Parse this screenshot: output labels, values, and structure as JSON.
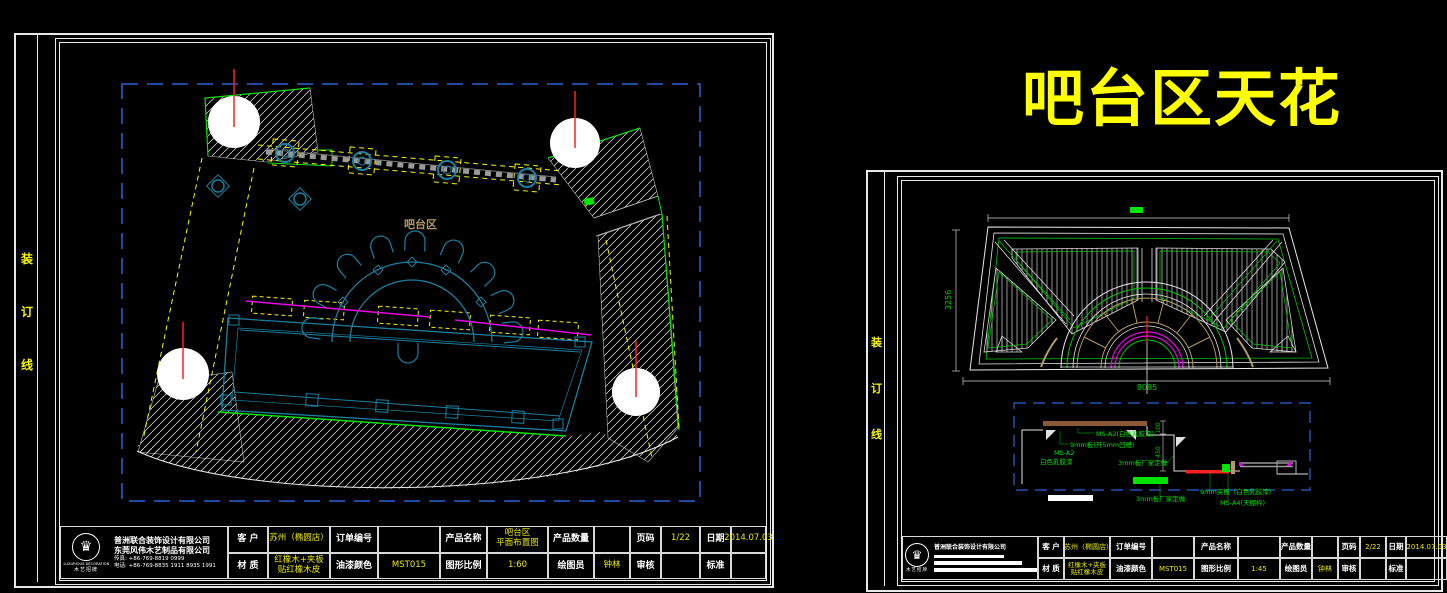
{
  "banner": {
    "title": "吧台区天花"
  },
  "palette": {
    "cad_blue": "#2a62d4",
    "cad_teal": "#1a7f9e",
    "cad_green": "#00e400",
    "cad_yellow": "#f8f800",
    "cad_magenta": "#e800e8",
    "cad_red": "#ff2020",
    "cad_tan": "#b29a62",
    "banner_yellow": "#ffff00"
  },
  "left_sheet": {
    "binding": [
      "装",
      "订",
      "线"
    ],
    "plan_label": "吧台区",
    "company": {
      "name1": "普洲联合装饰设计有限公司",
      "name2": "东莞风伟木艺制品有限公司",
      "tel1": "传真: +86-769-8819 0999",
      "tel2": "电话: +86-769-8835 1911 8935 1991",
      "logo_caption": "LUXURIOUS DECORATION",
      "logo_sub": "木艺招牌"
    },
    "fields": {
      "client_label": "客 户",
      "client": "苏州（椭圆店）",
      "order_label": "订单编号",
      "order": "",
      "product_label": "产品名称",
      "product": "吧台区\n平面布置图",
      "qty_label": "产品数量",
      "qty": "",
      "page_label": "页码",
      "page": "1/22",
      "date_label": "日期",
      "date": "2014.07.03",
      "material_label": "材 质",
      "material": "红橡木+夹板\n贴红橡木皮",
      "paint_label": "油漆颜色",
      "paint": "MST015",
      "scale_label": "图形比例",
      "scale": "1:60",
      "drafter_label": "绘图员",
      "drafter": "钟林",
      "review_label": "审核",
      "review": "",
      "standard_label": "标准",
      "standard": ""
    }
  },
  "right_sheet": {
    "binding": [
      "装",
      "订",
      "线"
    ],
    "dims": {
      "width": "8085",
      "height": "3256",
      "d100": "100",
      "d450": "450"
    },
    "labels": {
      "l1": "MS-A2(白色乳胶漆)",
      "l2": "9mm板(开5mm凹槽)",
      "l3": "MS-A2",
      "l4": "白色乳胶漆",
      "l5": "3mm板厂家定做",
      "l6": "3mm板厂家定做",
      "l7": "9mm夹板（白色乳胶漆）",
      "l8": "MS-A4(天棚枠)"
    },
    "company": {
      "name": "普洲联合装饰设计有限公司"
    },
    "fields": {
      "client_label": "客 户",
      "client": "苏州（椭圆店）",
      "order_label": "订单编号",
      "order": "",
      "product_label": "产品名称",
      "product": "",
      "qty_label": "产品数量",
      "qty": "",
      "page_label": "页码",
      "page": "2/22",
      "date_label": "日期",
      "date": "2014.07.03",
      "material_label": "材 质",
      "material": "红橡木+夹板\n贴红橡木皮",
      "paint_label": "油漆颜色",
      "paint": "MST015",
      "scale_label": "图形比例",
      "scale": "1:45",
      "drafter_label": "绘图员",
      "drafter": "钟林",
      "review_label": "审核",
      "review": "",
      "standard_label": "标准",
      "standard": ""
    }
  }
}
